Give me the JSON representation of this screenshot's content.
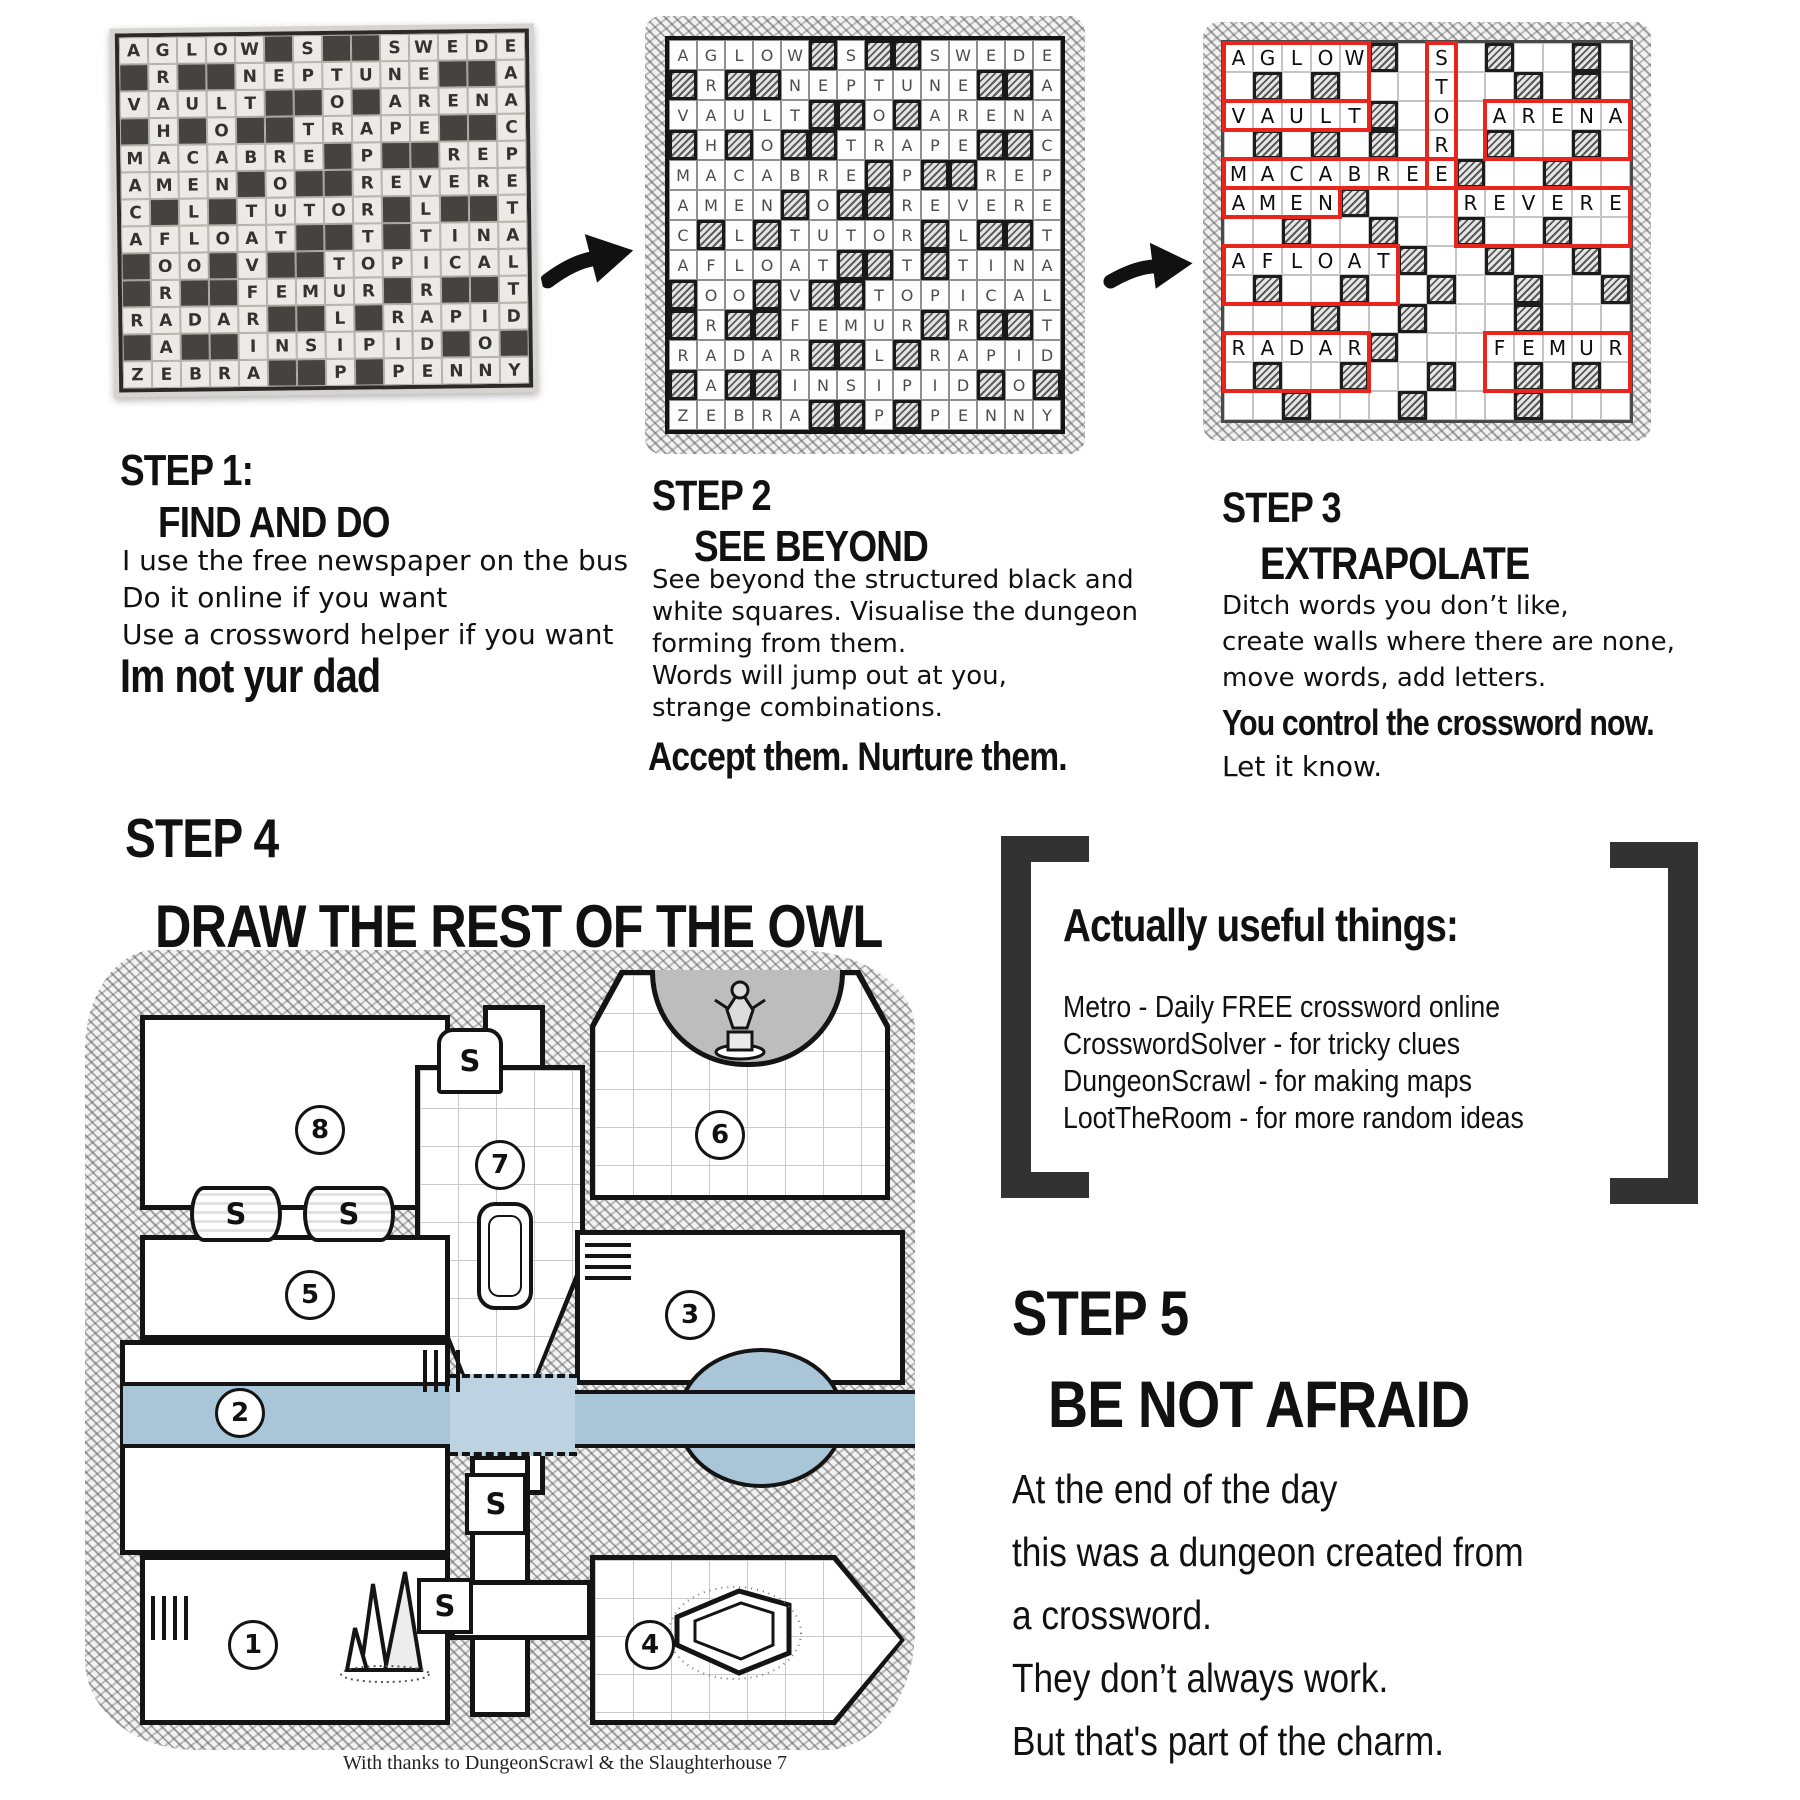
{
  "colors": {
    "red": "#e8261d",
    "river": "#a9c6d9",
    "bracket": "#323232",
    "apse": "#bdbdbd"
  },
  "steps": {
    "step1": {
      "title": "STEP 1:",
      "subtitle": "FIND AND DO",
      "body": [
        "I use the free newspaper on the bus",
        "Do it online if you want",
        "Use a crossword helper if you want"
      ],
      "emphasis": "Im not yur dad"
    },
    "step2": {
      "title": "STEP 2",
      "subtitle": "SEE BEYOND",
      "body": [
        "See beyond the structured black and",
        "white squares. Visualise the dungeon",
        "forming from them.",
        "Words will jump out at you,",
        "strange combinations."
      ],
      "emphasis": "Accept them. Nurture them."
    },
    "step3": {
      "title": "STEP 3",
      "subtitle": "EXTRAPOLATE",
      "body": [
        "Ditch words you don’t like,",
        "create walls where there are none,",
        "move words, add letters."
      ],
      "emphasis": "You control the crossword now.",
      "after": "Let it know."
    },
    "step4": {
      "title": "STEP 4",
      "subtitle": "DRAW THE REST OF THE OWL"
    },
    "step5": {
      "title": "STEP 5",
      "subtitle": "BE NOT AFRAID",
      "body": [
        "At the end of the day",
        "this was a dungeon created from",
        "a crossword.",
        "They don’t always work.",
        "But that's part of the charm."
      ]
    }
  },
  "useful": {
    "title": "Actually useful things:",
    "items": [
      "Metro - Daily FREE crossword online",
      "CrosswordSolver - for tricky clues",
      "DungeonScrawl - for making maps",
      "LootTheRoom - for more random ideas"
    ]
  },
  "crossword": {
    "rows": [
      "AGLOW#S##SWEDE",
      "#R##NEPTUNE##A",
      "VAULT##O#ARENA",
      "#H#O##TRAPE##C",
      "MACABRE#P##REP",
      "AMEN#O##REVERE",
      "C#L#TUTOR#L##T",
      "AFLOAT##T#TINA",
      "#OO#V##TOPICAL",
      "#R##FEMUR#R##T",
      "RADAR##L#RAPID",
      "#A##INSIPID#O#",
      "ZEBRA##P#PENNY"
    ]
  },
  "crossword3": {
    "rows": [
      "AGLOW#.S.#..#.",
      ".#.#...T..#.#.",
      "VAULT#.O.ARENA",
      ".#.#.#.R.#..#.",
      "MACABREE#..#..",
      "AMEN#...REVERE",
      "..#..#..#..#..",
      "AFLOAT#..#..#.",
      ".#..#..#..#..#",
      "...#..#...#...",
      "RADAR#...FEMUR",
      ".#..#..#..#.#.",
      "..#...#...#..."
    ],
    "rooms": [
      {
        "c": 0,
        "r": 0,
        "w": 5,
        "h": 2
      },
      {
        "c": 7,
        "r": 0,
        "w": 1,
        "h": 5
      },
      {
        "c": 0,
        "r": 2,
        "w": 5,
        "h": 1
      },
      {
        "c": 9,
        "r": 2,
        "w": 5,
        "h": 2
      },
      {
        "c": 0,
        "r": 4,
        "w": 8,
        "h": 1
      },
      {
        "c": 0,
        "r": 5,
        "w": 4,
        "h": 1
      },
      {
        "c": 8,
        "r": 5,
        "w": 6,
        "h": 2
      },
      {
        "c": 0,
        "r": 7,
        "w": 6,
        "h": 2
      },
      {
        "c": 0,
        "r": 10,
        "w": 5,
        "h": 2
      },
      {
        "c": 9,
        "r": 10,
        "w": 5,
        "h": 2
      }
    ]
  },
  "map": {
    "caption": "With thanks to DungeonScrawl & the Slaughterhouse 7",
    "rooms": [
      {
        "n": "8",
        "x": 55,
        "y": 65,
        "w": 310,
        "h": 195,
        "nx": 155,
        "ny": 90
      },
      {
        "n": "6",
        "x": 505,
        "y": 20,
        "w": 300,
        "h": 230,
        "nx": 105,
        "ny": 140,
        "shape": "cut-top"
      },
      {
        "n": "7",
        "x": 330,
        "y": 115,
        "w": 170,
        "h": 330,
        "nx": 60,
        "ny": 75,
        "shape": "taper-bottom"
      },
      {
        "n": "5",
        "x": 55,
        "y": 285,
        "w": 310,
        "h": 105,
        "nx": 145,
        "ny": 35
      },
      {
        "n": "3",
        "x": 490,
        "y": 280,
        "w": 330,
        "h": 155,
        "nx": 90,
        "ny": 60
      },
      {
        "n": "2",
        "x": 35,
        "y": 390,
        "w": 330,
        "h": 215,
        "nx": 95,
        "ny": 48
      },
      {
        "n": "1",
        "x": 55,
        "y": 605,
        "w": 310,
        "h": 170,
        "nx": 88,
        "ny": 65
      },
      {
        "n": "4",
        "x": 505,
        "y": 605,
        "w": 315,
        "h": 170,
        "nx": 35,
        "ny": 65,
        "shape": "point-right"
      }
    ],
    "corridors": [
      {
        "x": 398,
        "y": 55,
        "w": 62,
        "h": 95
      },
      {
        "x": 398,
        "y": 425,
        "w": 62,
        "h": 120
      },
      {
        "x": 385,
        "y": 505,
        "w": 60,
        "h": 262
      },
      {
        "x": 365,
        "y": 630,
        "w": 142,
        "h": 60
      },
      {
        "x": 120,
        "y": 252,
        "w": 180,
        "h": 42
      }
    ],
    "doors": [
      {
        "label": "S",
        "x": 352,
        "y": 78,
        "w": 66,
        "h": 66,
        "style": "arch"
      },
      {
        "label": "S",
        "x": 105,
        "y": 236,
        "w": 92,
        "h": 56,
        "style": "barrel"
      },
      {
        "label": "S",
        "x": 218,
        "y": 236,
        "w": 92,
        "h": 56,
        "style": "barrel"
      },
      {
        "label": "S",
        "x": 380,
        "y": 523,
        "w": 62,
        "h": 62,
        "style": "plain"
      },
      {
        "label": "S",
        "x": 332,
        "y": 628,
        "w": 56,
        "h": 56,
        "style": "plain"
      }
    ],
    "river": {
      "left": {
        "x": 38,
        "y": 432,
        "w": 327,
        "h": 66
      },
      "mid": {
        "x": 365,
        "y": 424,
        "w": 127,
        "h": 82
      },
      "right": {
        "x": 490,
        "y": 440,
        "w": 340,
        "h": 58
      },
      "pond": {
        "x": 592,
        "y": 398,
        "w": 168,
        "h": 140
      }
    },
    "stairs": [
      {
        "x": 500,
        "y": 293,
        "w": 46,
        "h": 40,
        "dir": "h"
      },
      {
        "x": 338,
        "y": 400,
        "w": 38,
        "h": 42,
        "dir": "v"
      },
      {
        "x": 66,
        "y": 646,
        "w": 38,
        "h": 44,
        "dir": "v"
      }
    ],
    "icons": [
      {
        "type": "statue",
        "x": 612,
        "y": 26
      },
      {
        "type": "sarcophagus",
        "x": 388,
        "y": 250
      },
      {
        "type": "crystals",
        "x": 242,
        "y": 608
      },
      {
        "type": "coffin",
        "x": 582,
        "y": 633
      }
    ]
  }
}
